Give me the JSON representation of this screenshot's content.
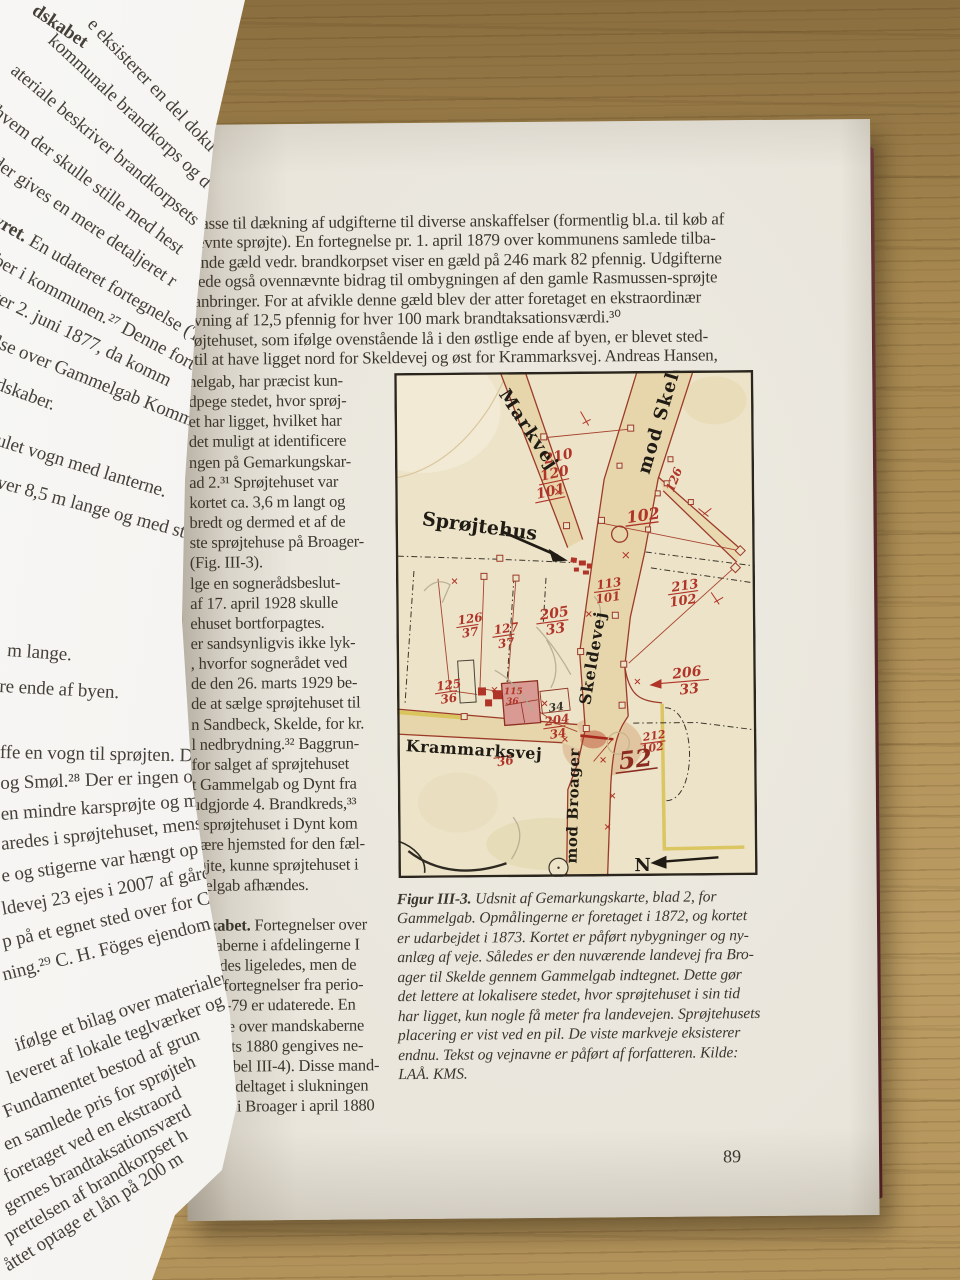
{
  "page_number": "89",
  "right_page": {
    "paragraph_lines": [
      "kasse til dækning af udgifterne til diverse anskaffelser (formentlig bl.a. til køb af",
      "ævnte sprøjte). En fortegnelse pr. 1. april 1879 over kommunens samlede tilba-",
      "ende gæld vedr. brandkorpset viser en gæld på 246 mark 82 pfennig. Udgifterne",
      "tede også ovennævnte bidrag til ombygningen af den gamle Rasmussen-sprøjte",
      "anbringer. For at afvikle denne gæld blev der atter foretaget en ekstraordinær",
      "vning af 12,5 pfennig for hver 100 mark brandtaksationsværdi.³⁰",
      "øjtehuset, som ifølge ovenstående lå i den østlige ende af byen, er blevet sted-",
      "til at have ligget nord for Skeldevej og øst for Krammarksvej. Andreas Hansen,"
    ],
    "mandskabet_lead": "dskabet.",
    "column_lines": [
      "nelgab, har præcist kun-",
      "dpege stedet, hvor sprøj-",
      "et har ligget, hvilket har",
      "det muligt at identificere",
      "ngen på Gemarkungskar-",
      "ad 2.³¹ Sprøjtehuset var",
      "kortet ca. 3,6 m langt og",
      "bredt og dermed et af de",
      "ste sprøjtehuse på Broager-",
      "(Fig. III-3).",
      "lge en sognerådsbeslut-",
      "af 17. april 1928 skulle",
      "ehuset bortforpagtes.",
      "er sandsynligvis ikke lyk-",
      ", hvorfor sognerådet ved",
      "de den 26. marts 1929 be-",
      "de at sælge sprøjtehuset til",
      "n Sandbeck, Skelde, for kr.",
      "l nedbrydning.³² Baggrun-",
      "for salget af sprøjtehuset",
      "t Gammelgab og Dynt fra",
      "udgjorde 4. Brandkreds,³³",
      "a sprøjtehuset i Dynt kom",
      "være hjemsted for den fæl-",
      "røjte, kunne sprøjtehuset i",
      "melgab afhændes.",
      "Fortegnelser over",
      "dskaberne i afdelingerne I",
      "l findes ligeledes, men de",
      "gste fortegnelser fra perio-",
      "1876-79 er udaterede. En",
      "gnelse over mandskaberne",
      "6 marts 1880 gengives ne-",
      "or (Tabel III-4). Disse mand-",
      "er har deltaget i slukningen",
      "anden i Broager i april 1880"
    ],
    "caption_lead": "Figur III-3.",
    "caption_lines": [
      "Udsnit af Gemarkungskarte, blad 2, for",
      "Gammelgab. Opmålingerne er foretaget i 1872, og kortet",
      "er udarbejdet i 1873. Kortet er påført nybygninger og ny-",
      "anlæg af veje. Således er den nuværende landevej fra Bro-",
      "ager til Skelde gennem Gammelgab indtegnet. Dette gør",
      "det lettere at lokalisere stedet, hvor sprøjtehuset i sin tid",
      "har ligget, kun nogle få meter fra landevejen. Sprøjtehusets",
      "placering er vist ved en pil. De viste markveje eksisterer",
      "endnu. Tekst og vejnavne er påført af forfatteren. Kilde:",
      "LAÅ. KMS."
    ]
  },
  "left_page": {
    "heading": "dskabet",
    "para_lead": "yret.",
    "lines": [
      "e eksisterer en del doku",
      "kommunale brandkorps og d",
      "ateriale beskriver brandkorpsets",
      "hvem der skulle stille med hest",
      "der gives en mere detaljeret r",
      "En udateret fortegnelse (Ta",
      "ber i kommunen.²⁷ Denne fort",
      "ter 2. juni 1877, da komm",
      "lse over Gammelgab Komm",
      "dskaber.",
      "ulet vogn med lanterne.",
      "ver 8,5 m lange og med stråler",
      "m lange.",
      "re ende af byen.",
      "ffe en vogn til sprøjten. Dog sk",
      "og Smøl.²⁸ Der er ingen oplysn",
      "en mindre karsprøjte og mulig",
      "aredes i sprøjtehuset, mens bra",
      "e og stigerne var hængt op på m",
      "ldevej 23 ejes i 2007 af gårde",
      "p på et egnet sted over for C. H",
      "ning.²⁹ C. H. Föges ejendom p",
      "ifølge et bilag over materialer",
      "leveret af lokale teglværker og",
      "Fundamentet bestod af grun",
      "en samlede pris for sprøjteh",
      "foretaget ved en ekstraord",
      "gernes brandtaksationsværd",
      "prettelsen af brandkorpset h",
      "åttet optage et lån på 200 m"
    ]
  },
  "map": {
    "labels": {
      "markvej": "Markvej",
      "mod_skelde": "mod Skelde",
      "sprojtehus": "Sprøjtehus",
      "skeldevej": "Skeldevej",
      "krammarksvej": "Krammarksvej",
      "mod_broager": "mod Broager",
      "north": "N"
    },
    "numbers": {
      "n210": "210",
      "n120": "120",
      "n101a": "101",
      "n102": "102",
      "n126r": "126",
      "n113": "113",
      "n101b": "101",
      "n213": "213",
      "n102b": "102",
      "n205": "205",
      "n33a": "33",
      "n126": "126",
      "n37a": "37",
      "n127": "127",
      "n37b": "37",
      "n125": "125",
      "n36a": "36",
      "n34a": "34",
      "n204": "204",
      "n34b": "34",
      "n206": "206",
      "n33b": "33",
      "n212": "212",
      "n102c": "102",
      "n52": "52",
      "n36b": "36",
      "n115": "115",
      "n36c": "36"
    },
    "ink_red": "#b03428",
    "ink_black": "#201c15",
    "paper": "#ece3c8",
    "road_fill": "#e7d6ab",
    "highlight_yellow": "#d9c255"
  }
}
